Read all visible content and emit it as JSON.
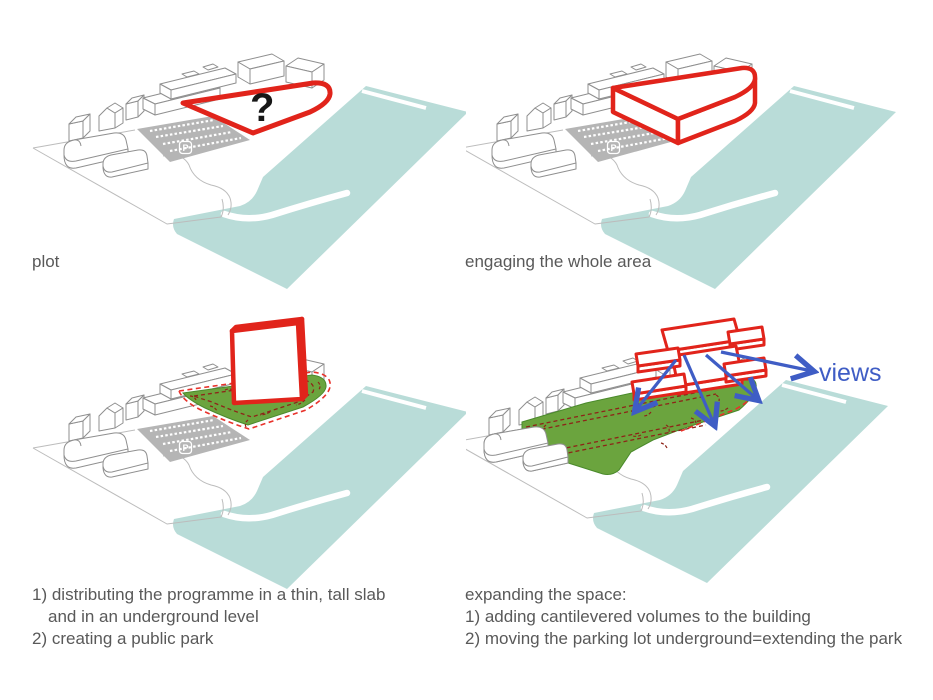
{
  "title": "architectural concept diagram",
  "site": {
    "parking_label": "P"
  },
  "panels": [
    {
      "id": "plot",
      "label": "plot",
      "question_mark": "?"
    },
    {
      "id": "engaging",
      "label": "engaging the whole area"
    },
    {
      "id": "slab-park",
      "caption_lines": [
        "1) distributing the programme in a thin, tall slab",
        "and in an underground level",
        "2) creating a public park"
      ]
    },
    {
      "id": "expanding",
      "caption_lines": [
        "expanding the space:",
        "1) adding cantilevered volumes to the building",
        "2) moving the parking lot underground=extending the park"
      ],
      "views_label": "views"
    }
  ],
  "colors": {
    "red_outline": "#e1241b",
    "dashed_red": "#e8322b",
    "dark_red_marks": "#8e2418",
    "park_green": "#6ba43e",
    "water_teal": "#b9dcd8",
    "parking_gray": "#b5b5b5",
    "building_line_gray": "#8f8f8f",
    "caption_gray": "#595959",
    "arrow_blue": "#3f5dc5",
    "background": "#ffffff"
  }
}
